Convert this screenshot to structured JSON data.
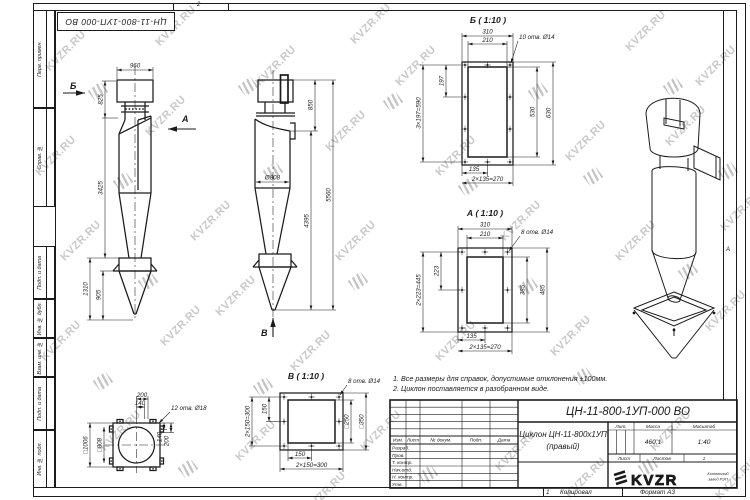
{
  "watermark": {
    "text": "KVZR.RU"
  },
  "frame": {
    "ref_box": "ЦН-11-800-1УП-000 ВО",
    "zone_top": "2",
    "zone_bottom": "1",
    "zone_right": "А",
    "left_labels": [
      "Перв. примен.",
      "Справ. №",
      "Подп. и дата",
      "Инв. № дубл.",
      "Взам. инв. №",
      "Подп. и дата",
      "Инв. № подл."
    ]
  },
  "front_view": {
    "dir_b": "Б",
    "dir_a": "А",
    "dim_960": "960",
    "dim_825": "825",
    "dim_3425": "3425",
    "dim_1310": "1310",
    "dim_905": "905"
  },
  "side_view": {
    "dir_v": "В",
    "dim_850": "850",
    "dim_5560": "5560",
    "dim_4395": "4395",
    "dim_d808": "Ø808"
  },
  "view_b": {
    "title": "Б ( 1:10 )",
    "holes_note": "10 отв. Ø14",
    "dim_310": "310",
    "dim_210": "210",
    "dim_197": "197",
    "dim_3x197": "3×197=590",
    "dim_530": "530",
    "dim_630": "630",
    "dim_135": "135",
    "dim_2x135": "2×135=270"
  },
  "view_a": {
    "title": "А ( 1:10 )",
    "holes_note": "8 отв. Ø14",
    "dim_310": "310",
    "dim_210": "210",
    "dim_223": "223",
    "dim_2x223": "2×223=445",
    "dim_385": "385",
    "dim_485": "485",
    "dim_135": "135",
    "dim_2x135": "2×135=270"
  },
  "view_v": {
    "title": "В ( 1:10 )",
    "holes_note": "8 отв. Ø14",
    "dim_150l": "150",
    "dim_2x150l": "2×150=300",
    "dim_250": "□250",
    "dim_350": "□350",
    "dim_150b": "150",
    "dim_2x150b": "2×150=300"
  },
  "base_view": {
    "holes_note": "12 отв. Ø18",
    "dim_200t": "200",
    "dim_140t": "140",
    "dim_1006": "□1006",
    "dim_808": "□808",
    "dim_140r": "140",
    "dim_200r": "200"
  },
  "notes": {
    "line1": "1. Все размеры для справок, допустимые отклонения ±100мм.",
    "line2": "2. Циклон поставляется в разобранном виде."
  },
  "title_block": {
    "doc_number": "ЦН-11-800-1УП-000 ВО",
    "product_name": "Циклон ЦН-11-800х1УП",
    "product_variant": "(правый)",
    "col_izm": "Изм.",
    "col_list": "Лист",
    "col_dokum": "№ докум.",
    "col_podp": "Подп.",
    "col_data": "Дата",
    "rows": [
      "Разраб.",
      "Пров.",
      "Т. контр.",
      "Нач.отд.",
      "Н. контр.",
      "Утв."
    ],
    "lit_label": "Лит.",
    "mass_label": "Масса",
    "scale_label": "Масштаб",
    "mass_value": "460,1",
    "scale_value": "1:40",
    "sheet_label": "Лист",
    "sheets_label": "Листов",
    "sheets_value": "1",
    "logo_text": "KVZR",
    "logo_sub1": "Котельный",
    "logo_sub2": "завод РЭП",
    "footer_copy": "Копировал",
    "footer_format": "Формат А3"
  }
}
